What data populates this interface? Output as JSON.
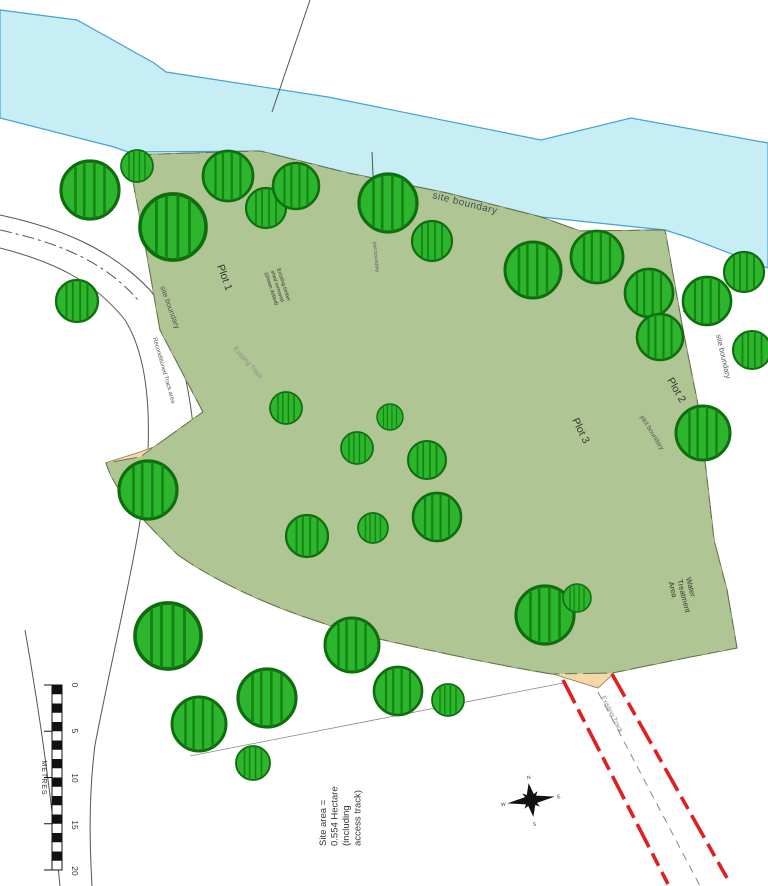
{
  "labels": {
    "site_boundary_top": "site boundary",
    "site_boundary_left": "site boundary",
    "site_boundary_right": "site boundary",
    "plot_1": "Plot 1",
    "plot_2": "Plot 2",
    "plot_3": "Plot 3",
    "plot_boundary_right": "plot boundary",
    "plot_boundary_inner": "plot boundary",
    "existing_track_upper": "Existing Track",
    "existing_track_lower": "Existing Track",
    "reconditioned_track": "Reconditioned Track area",
    "shed_note": [
      "Existing timber",
      "shed removed",
      "(shown dotted)"
    ],
    "water_treatment": [
      "Water",
      "Treatment",
      "Area"
    ]
  },
  "area_note": [
    "Site area =",
    "0.554 Hectare",
    "(including",
    "access track)"
  ],
  "scale_bar": {
    "ticks": [
      "0",
      "5",
      "10",
      "15",
      "20"
    ],
    "unit": "METRES"
  },
  "compass": {
    "n": "N",
    "e": "E",
    "s": "S",
    "w": "W"
  },
  "colors": {
    "site_boundary_red": "#e02020",
    "river_blue": "#c7eef4",
    "site_green": "#b0c594",
    "tree_green": "#2eb52e",
    "track_beige": "#f6d7a6"
  }
}
